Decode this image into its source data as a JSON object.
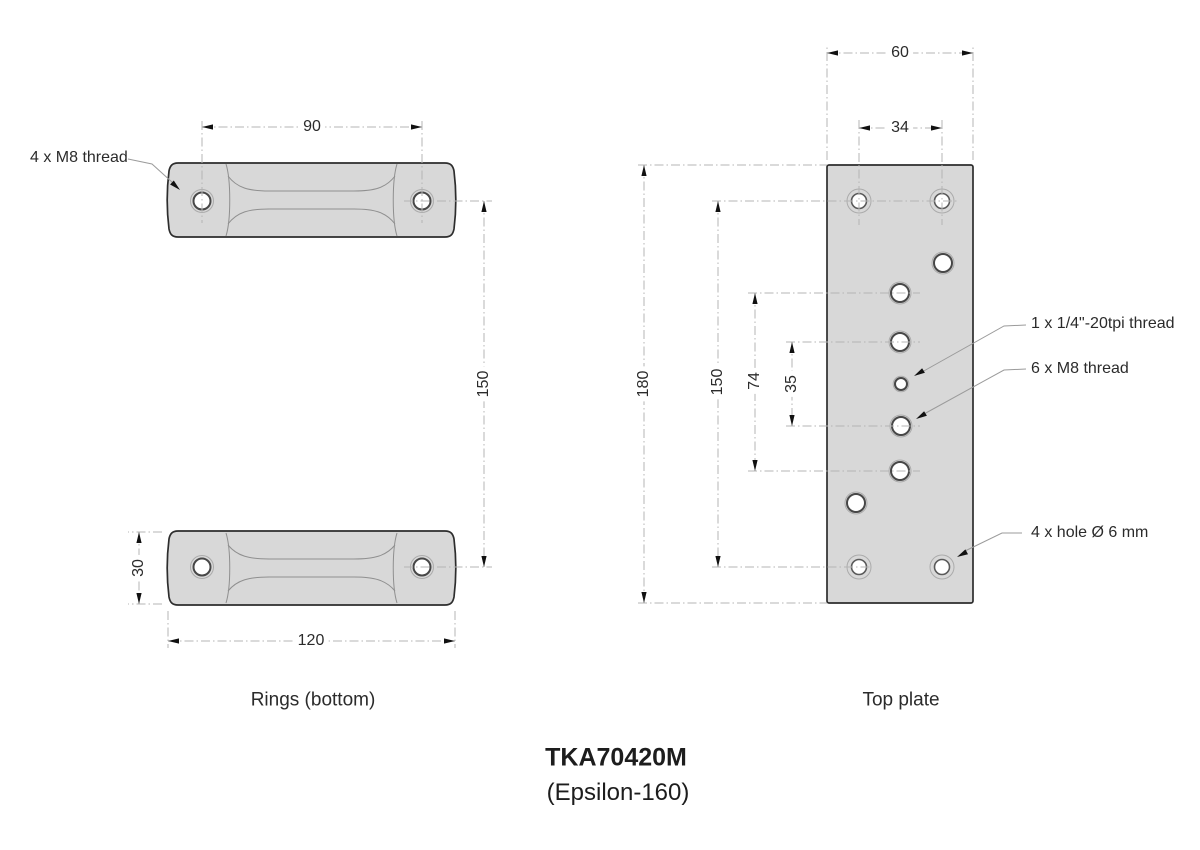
{
  "title": {
    "model": "TKA70420M",
    "variant": "(Epsilon-160)"
  },
  "views": {
    "rings": {
      "caption": "Rings (bottom)",
      "annotations": {
        "thread": "4 x M8 thread"
      },
      "dimensions": {
        "hole_spacing": "90",
        "ring_vertical_spacing": "150",
        "ring_height": "30",
        "ring_length": "120"
      }
    },
    "plate": {
      "caption": "Top plate",
      "annotations": {
        "quarter_thread": "1 x 1/4\"-20tpi thread",
        "m8_thread": "6 x M8 thread",
        "corner_holes": "4 x hole Ø 6 mm"
      },
      "dimensions": {
        "plate_width": "60",
        "top_hole_spacing": "34",
        "plate_height": "180",
        "corner_hole_spacing": "150",
        "m8_outer_span": "74",
        "m8_inner_span": "35"
      }
    }
  },
  "colors": {
    "part_fill": "#d8d8d8",
    "part_outline": "#2d2d2d",
    "dimension_line": "#b4b4b4",
    "arrow": "#111111",
    "text": "#262626"
  }
}
